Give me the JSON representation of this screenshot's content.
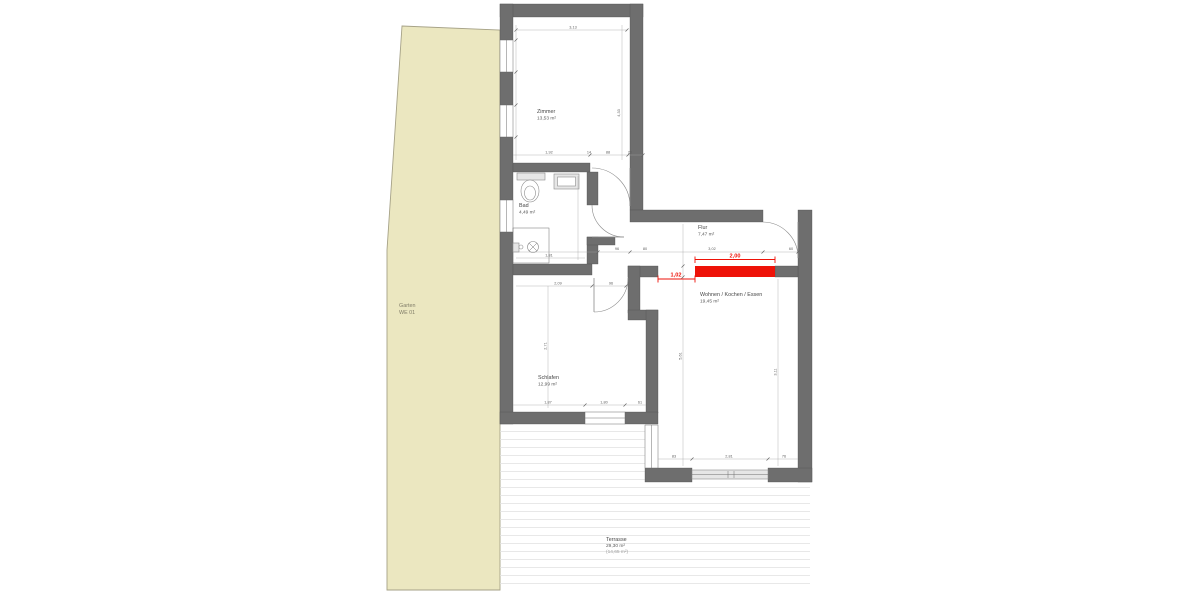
{
  "colors": {
    "wall": "#6e6e6e",
    "garden": "#ebe7c0",
    "highlight": "#ee1208"
  },
  "garden": {
    "name": "Garten",
    "unit": "WE 01"
  },
  "rooms": {
    "zimmer": {
      "name": "Zimmer",
      "area": "13,53 m²"
    },
    "bad": {
      "name": "Bad",
      "area": "4,49 m²"
    },
    "flur": {
      "name": "Flur",
      "area": "7,47 m²"
    },
    "wohnen": {
      "name": "Wohnen / Kochen / Essen",
      "area": "19,45 m²"
    },
    "schlafen": {
      "name": "Schlafen",
      "area": "12,99 m²"
    },
    "terrasse": {
      "name": "Terrasse",
      "area": "29,30 m²",
      "area_secondary": "(14,65 m²)"
    }
  },
  "highlight": {
    "length": "2,00",
    "offset": "1,02"
  },
  "dims": {
    "zimmer_top": "3,13",
    "zimmer_right": "4,33",
    "zimmer_bottom_1": "1,92",
    "zimmer_bottom_2": "14",
    "zimmer_bottom_3": "88",
    "zimmer_bottom_4": "26",
    "bad_width": "1,81",
    "flur_1": "96",
    "flur_2": "80",
    "flur_3": "3,02",
    "flur_4": "60",
    "schlafen_top_1": "2,09",
    "schlafen_top_2": "96",
    "schlafen_left": "2,71",
    "schlafen_bottom_1": "1,87",
    "schlafen_bottom_2": "1,80",
    "schlafen_bottom_3": "61",
    "wohnen_bottom_1": "83",
    "wohnen_bottom_2": "2,81",
    "wohnen_bottom_3": "76",
    "wohnen_left": "5,61",
    "wohnen_right": "3,11"
  }
}
